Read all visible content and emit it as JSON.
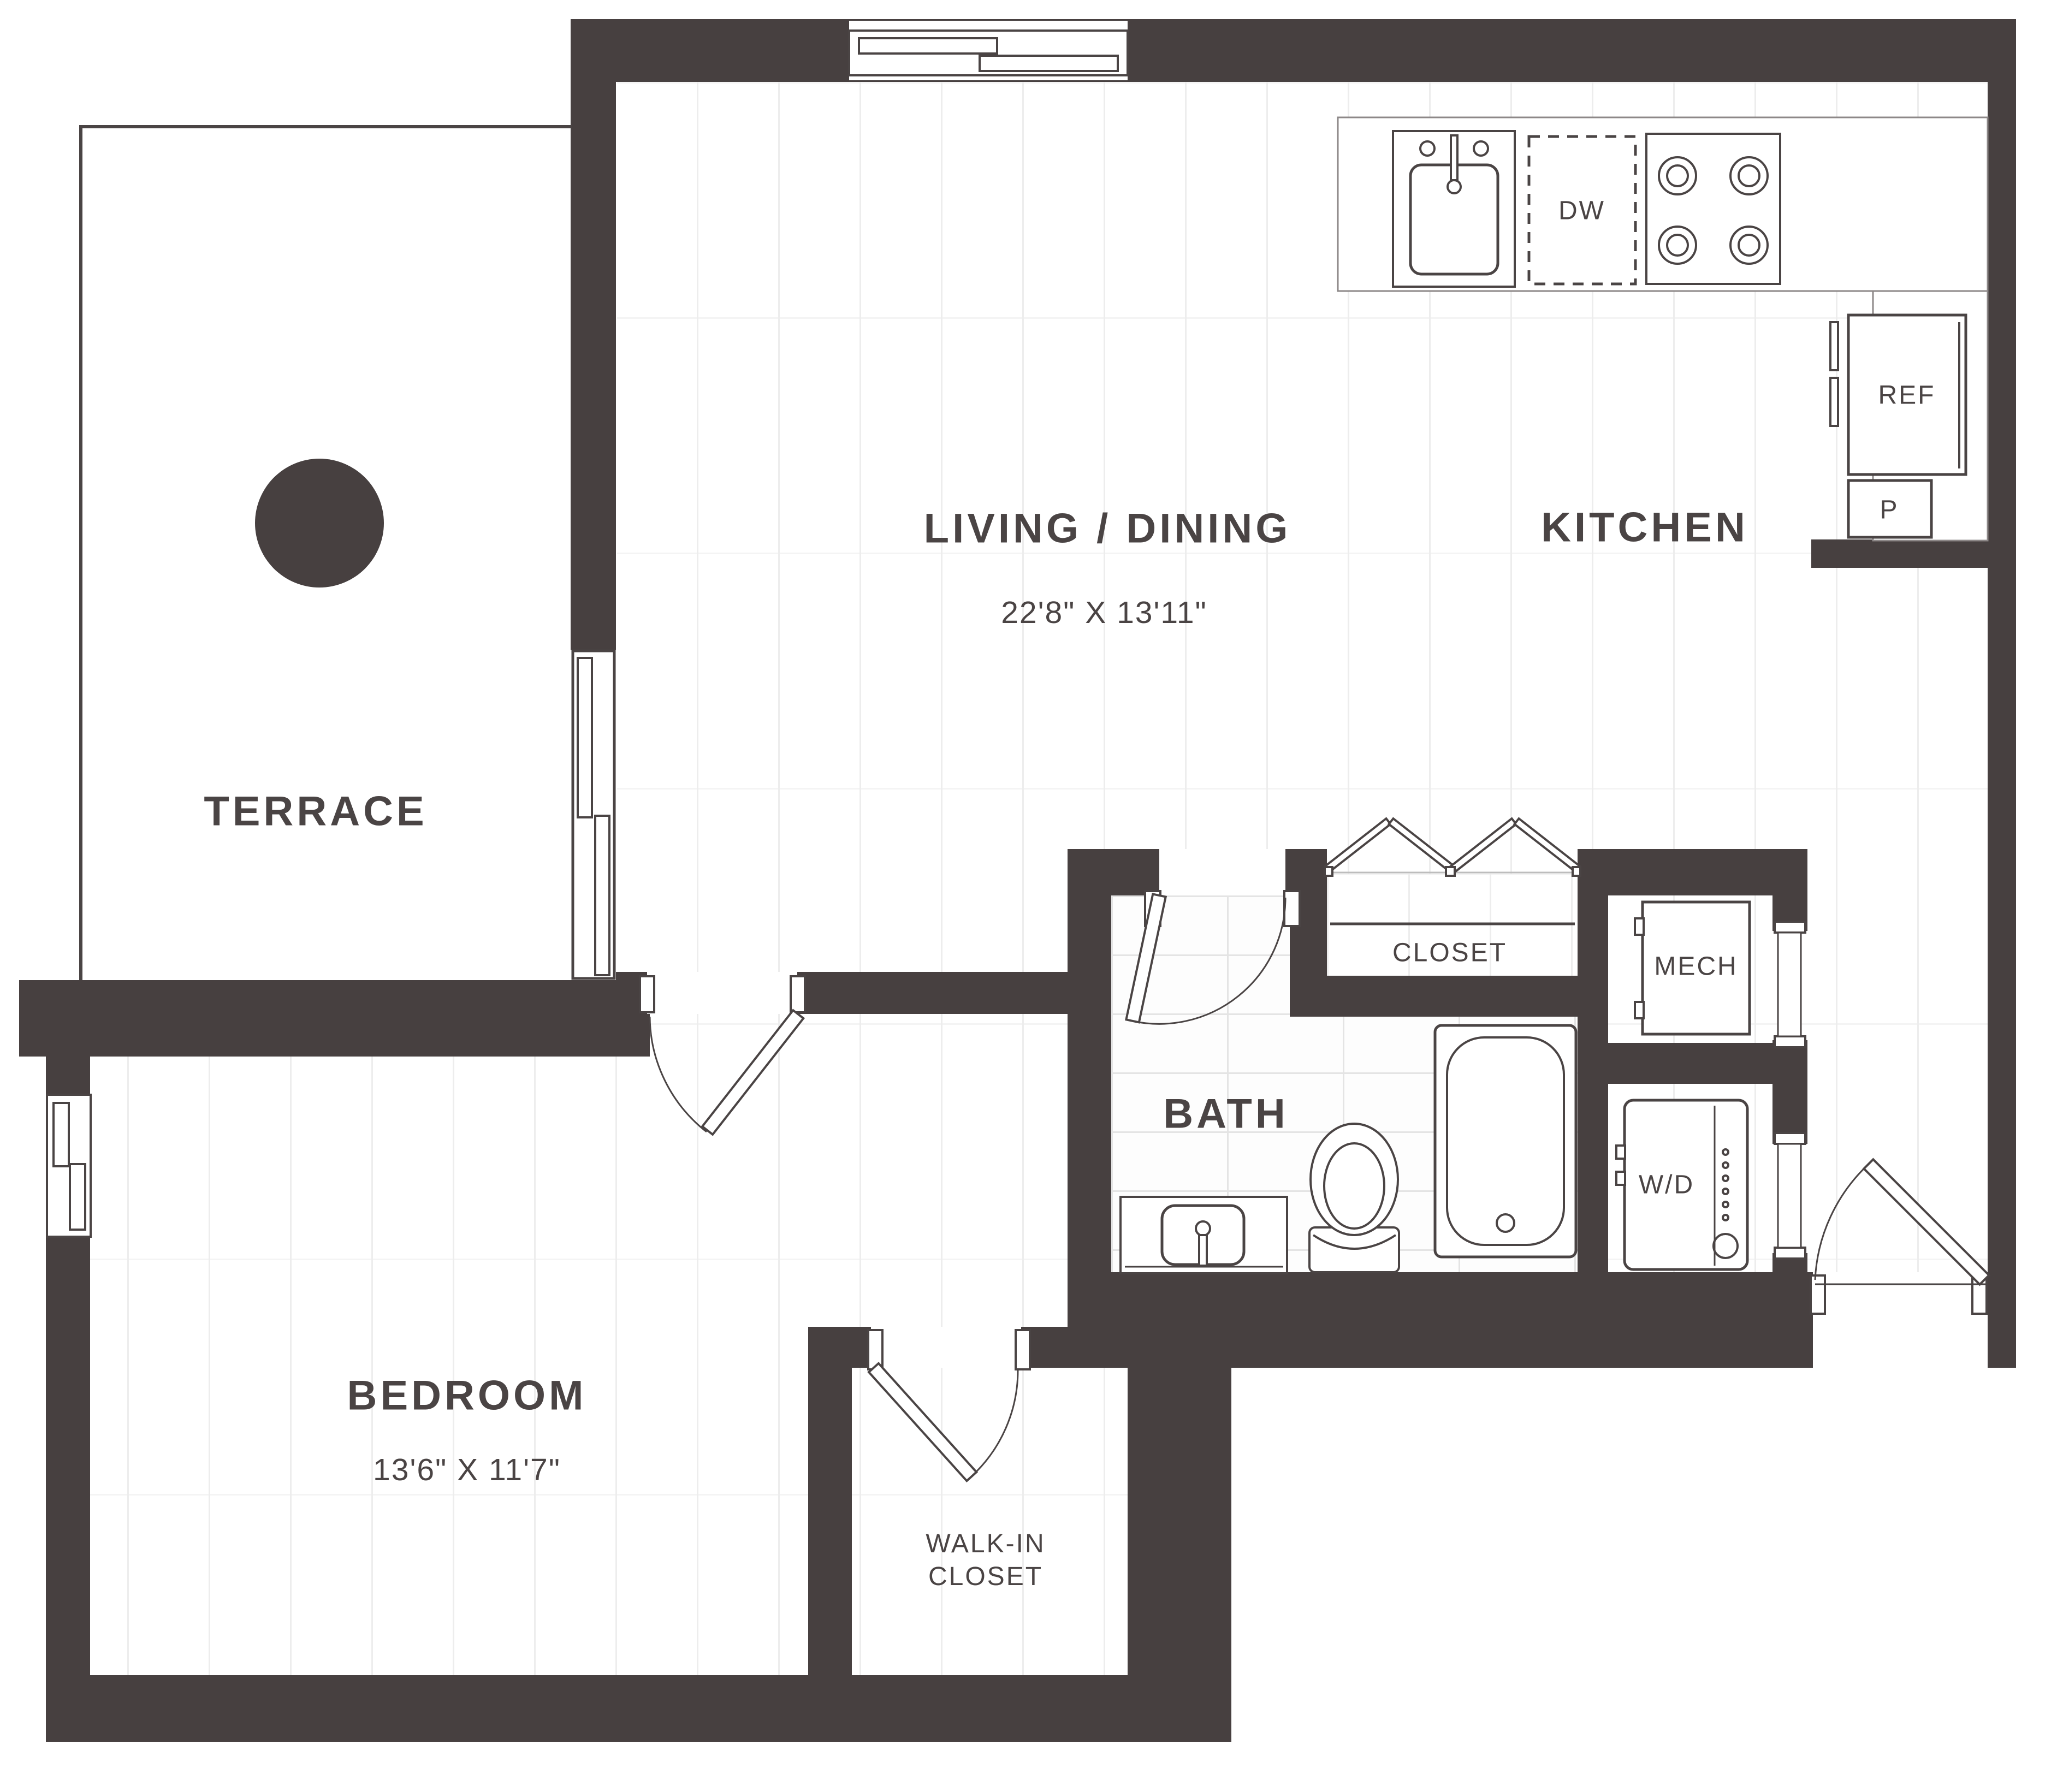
{
  "plan": {
    "rooms": {
      "terrace": {
        "label": "TERRACE"
      },
      "living_dining": {
        "label": "LIVING / DINING",
        "dimensions": "22'8\" X 13'11\""
      },
      "kitchen": {
        "label": "KITCHEN"
      },
      "bedroom": {
        "label": "BEDROOM",
        "dimensions": "13'6\" X 11'7\""
      },
      "bath": {
        "label": "BATH"
      },
      "closet": {
        "label": "CLOSET"
      },
      "walk_in_closet": {
        "label_line1": "WALK-IN",
        "label_line2": "CLOSET"
      },
      "mech": {
        "label": "MECH"
      }
    },
    "appliances": {
      "dishwasher": "DW",
      "refrigerator": "REF",
      "pantry": "P",
      "washer_dryer": "W/D"
    },
    "colors": {
      "wall": "#474040",
      "line": "#4a4444",
      "plank_line": "#ededed",
      "tile_line": "#e4e4e4",
      "floor": "#ffffff"
    },
    "icons": [
      "terrace-table-icon",
      "sliding-door-icon",
      "window-icon",
      "kitchen-sink-icon",
      "stove-icon",
      "dishwasher-icon",
      "refrigerator-icon",
      "pantry-icon",
      "bifold-doors-icon",
      "door-swing-icon",
      "bathtub-icon",
      "toilet-icon",
      "vanity-sink-icon",
      "mech-unit-icon",
      "washer-dryer-icon"
    ]
  }
}
